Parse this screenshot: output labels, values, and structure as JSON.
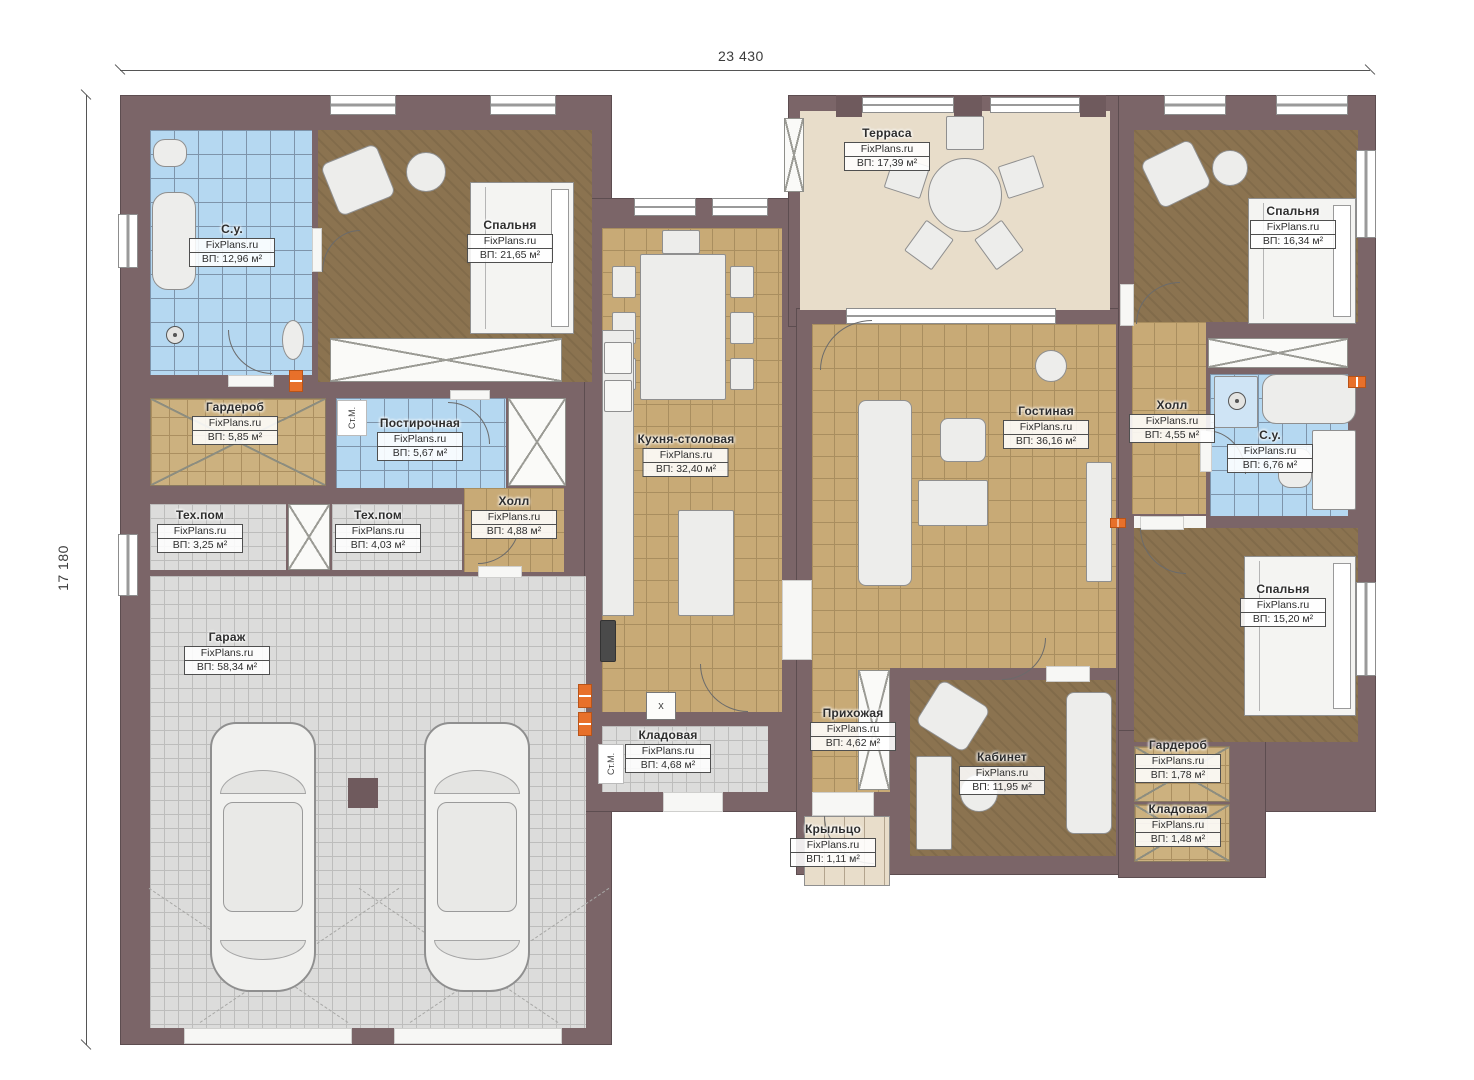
{
  "plan": {
    "watermark": "FixPlans.ru",
    "dim_width": "23 430",
    "dim_height": "17 180",
    "area_prefix": "ВП:"
  },
  "rooms": [
    {
      "id": "bathroom-1",
      "name": "С.у.",
      "area": "ВП: 12,96 м²"
    },
    {
      "id": "bedroom-1",
      "name": "Спальня",
      "area": "ВП: 21,65 м²"
    },
    {
      "id": "wardrobe-1",
      "name": "Гардероб",
      "area": "ВП: 5,85 м²"
    },
    {
      "id": "laundry",
      "name": "Постирочная",
      "area": "ВП: 5,67 м²"
    },
    {
      "id": "tech-room-1",
      "name": "Тех.пом",
      "area": "ВП: 3,25 м²"
    },
    {
      "id": "tech-room-2",
      "name": "Тех.пом",
      "area": "ВП: 4,03 м²"
    },
    {
      "id": "hall-1",
      "name": "Холл",
      "area": "ВП: 4,88 м²"
    },
    {
      "id": "garage",
      "name": "Гараж",
      "area": "ВП: 58,34 м²"
    },
    {
      "id": "kitchen-dining",
      "name": "Кухня-столовая",
      "area": "ВП: 32,40 м²"
    },
    {
      "id": "storage-1",
      "name": "Кладовая",
      "area": "ВП: 4,68 м²"
    },
    {
      "id": "terrace",
      "name": "Терраса",
      "area": "ВП: 17,39 м²"
    },
    {
      "id": "living-room",
      "name": "Гостиная",
      "area": "ВП: 36,16 м²"
    },
    {
      "id": "entry-hall",
      "name": "Прихожая",
      "area": "ВП: 4,62 м²"
    },
    {
      "id": "office",
      "name": "Кабинет",
      "area": "ВП: 11,95 м²"
    },
    {
      "id": "porch",
      "name": "Крыльцо",
      "area": "ВП: 1,11 м²"
    },
    {
      "id": "bedroom-2",
      "name": "Спальня",
      "area": "ВП: 16,34 м²"
    },
    {
      "id": "hall-2",
      "name": "Холл",
      "area": "ВП: 4,55 м²"
    },
    {
      "id": "bathroom-2",
      "name": "С.у.",
      "area": "ВП: 6,76 м²"
    },
    {
      "id": "bedroom-3",
      "name": "Спальня",
      "area": "ВП: 15,20 м²"
    },
    {
      "id": "wardrobe-2",
      "name": "Гардероб",
      "area": "ВП: 1,78 м²"
    },
    {
      "id": "storage-2",
      "name": "Кладовая",
      "area": "ВП: 1,48 м²"
    }
  ],
  "annotations": {
    "washer": "Ст.М.",
    "cross_mark": "x"
  },
  "colors": {
    "wall": "#7b6568",
    "floor_wood": "#8b7350",
    "floor_tile_tan": "#c8aa76",
    "floor_tile_blue": "#b5d8f1",
    "floor_tile_gray": "#dcdcdb",
    "terrace_beige": "#e8ddca",
    "marker_orange": "#e8702a"
  }
}
